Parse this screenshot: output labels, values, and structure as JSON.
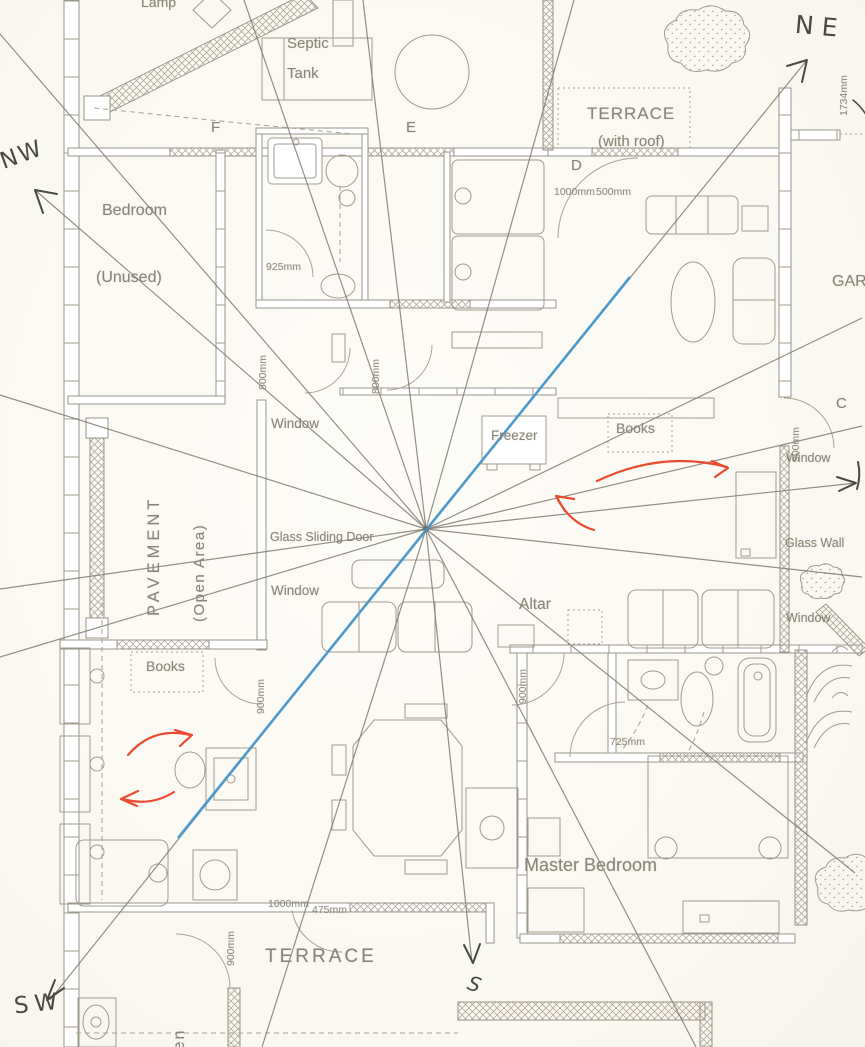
{
  "palette": {
    "paper": "#fbfaf4",
    "plan_line": "#9a9489",
    "plan_text": "#8b8578",
    "sector_line": "#7f7b72",
    "facing_line_blue": "#4593cc",
    "flow_arrow_red": "#e84b30",
    "ink": "#4a4a45"
  },
  "compass": {
    "nw": "NW",
    "ne": "NE",
    "sw": "SW",
    "s": "S"
  },
  "markers": {
    "f": "F",
    "e": "E",
    "d": "D",
    "c": "C"
  },
  "rooms": {
    "bedroom": "Bedroom",
    "bedroom_note": "(Unused)",
    "terrace_roof": "TERRACE",
    "terrace_roof_note": "(with roof)",
    "pavement": "PAVEMENT",
    "pavement_note": "(Open Area)",
    "master_bedroom": "Master Bedroom",
    "terrace": "TERRACE",
    "garden": "GAR",
    "kitchen": "Kitchen"
  },
  "features": {
    "septic_1": "Septic",
    "septic_2": "Tank",
    "lamp": "Lamp",
    "freezer": "Freezer",
    "books": "Books",
    "altar": "Altar",
    "window": "Window",
    "glass_sliding_door": "Glass Sliding Door",
    "glass_wall": "Glass Wall"
  },
  "dimensions": {
    "d925": "925mm",
    "d800": "800mm",
    "d900": "900mm",
    "d1000": "1000mm",
    "d500": "500mm",
    "d475": "475mm",
    "d725": "725mm",
    "d1734": "1734mm"
  }
}
